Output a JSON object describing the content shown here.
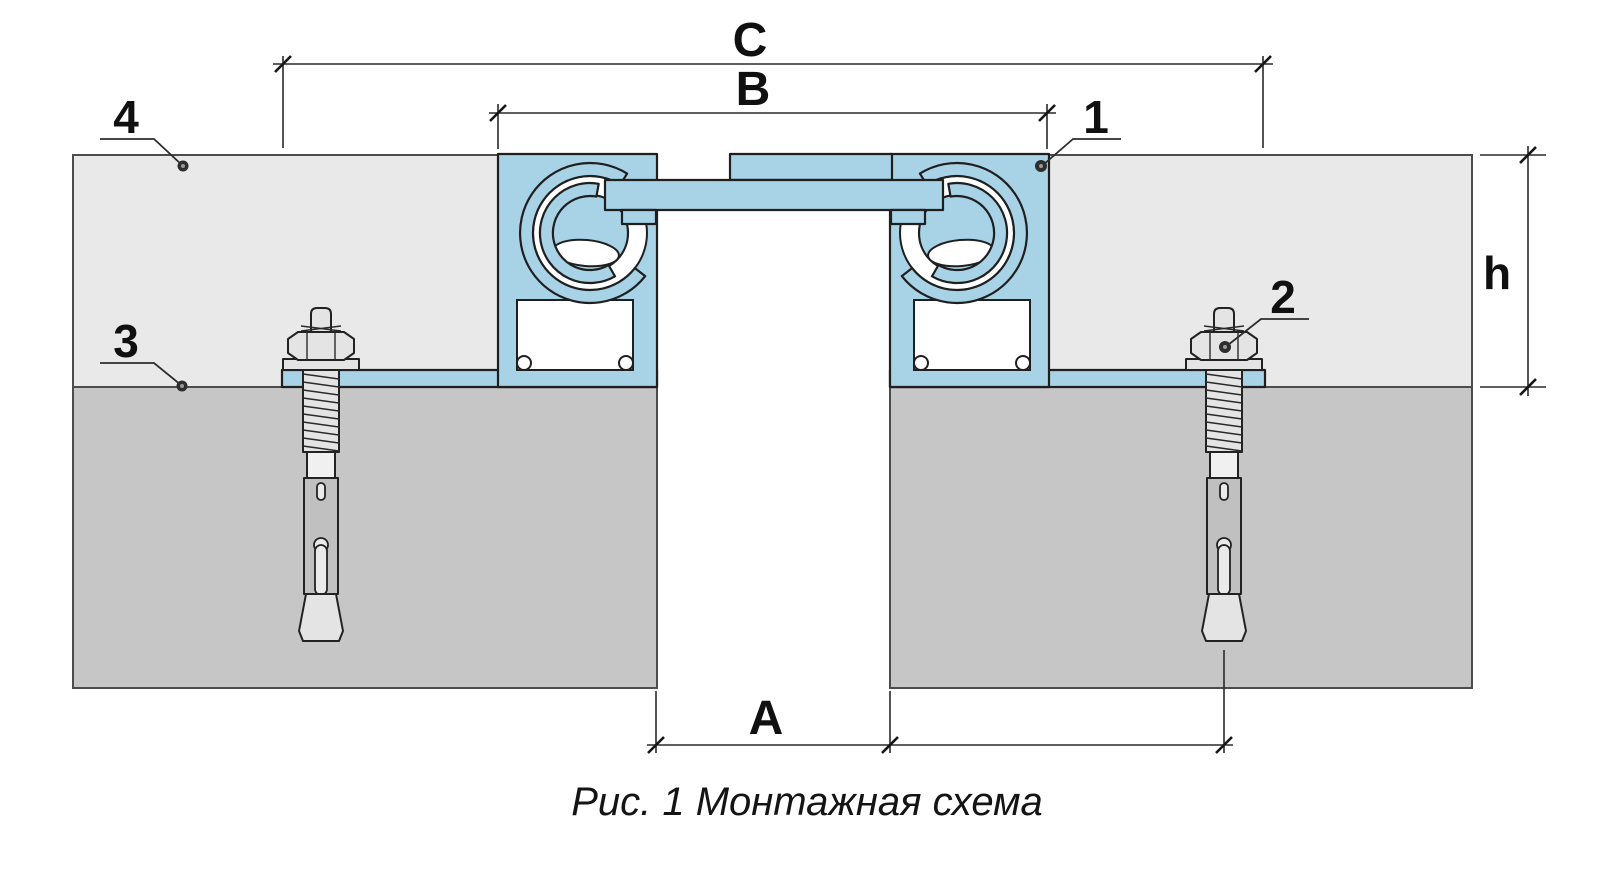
{
  "figure": {
    "caption": "Рис. 1 Монтажная схема"
  },
  "dimensions": {
    "overall_width": "C",
    "profile_width": "B",
    "joint_gap": "A",
    "layer_height": "h"
  },
  "callouts": {
    "c1": "1",
    "c2": "2",
    "c3": "3",
    "c4": "4"
  },
  "colors": {
    "profile_blue": "#a8d3e7",
    "screed_gray": "#e9e9e9",
    "base_gray": "#c6c6c6",
    "outline": "#1f1f1f",
    "dim_color": "#2a2a2a",
    "label_color": "#101010"
  }
}
